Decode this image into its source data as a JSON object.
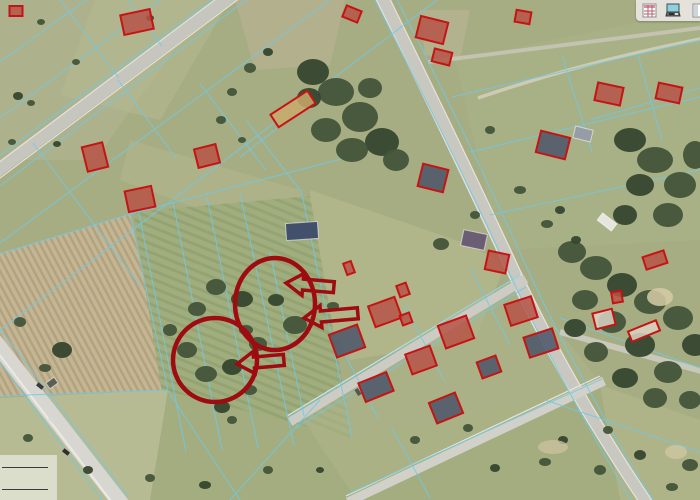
{
  "toolbar": {
    "icons": [
      {
        "name": "attribute-table-icon"
      },
      {
        "name": "print-preview-icon"
      },
      {
        "name": "side-panel-icon"
      }
    ]
  },
  "scalebar": {
    "bars": [
      {
        "width": 46
      },
      {
        "width": 46
      }
    ]
  },
  "map": {
    "colors": {
      "field": "#a7ad83",
      "parcel_line": "#6fc9e6",
      "building_outline": "#c51414",
      "annotation": "#9e0b10",
      "roofs": {
        "red": "#b65348",
        "dark": "#4b5569",
        "light": "#dad3c5",
        "tan": "#c9a96a"
      }
    },
    "buildings": [
      [
        16,
        11,
        13,
        10,
        0,
        "red"
      ],
      [
        137,
        22,
        30,
        20,
        -12,
        "red"
      ],
      [
        352,
        14,
        16,
        12,
        22,
        "red"
      ],
      [
        95,
        157,
        21,
        25,
        -14,
        "red"
      ],
      [
        207,
        156,
        22,
        19,
        -14,
        "red"
      ],
      [
        140,
        199,
        27,
        21,
        -12,
        "red"
      ],
      [
        293,
        109,
        44,
        15,
        -33,
        "tan"
      ],
      [
        432,
        30,
        28,
        22,
        14,
        "red"
      ],
      [
        442,
        57,
        18,
        13,
        14,
        "red"
      ],
      [
        523,
        17,
        15,
        12,
        10,
        "red"
      ],
      [
        609,
        94,
        26,
        18,
        12,
        "red"
      ],
      [
        669,
        93,
        24,
        16,
        12,
        "red"
      ],
      [
        553,
        145,
        30,
        22,
        14,
        "dark"
      ],
      [
        433,
        178,
        26,
        23,
        14,
        "dark"
      ],
      [
        497,
        262,
        21,
        19,
        12,
        "red"
      ],
      [
        521,
        311,
        28,
        22,
        -18,
        "red"
      ],
      [
        541,
        343,
        30,
        21,
        -18,
        "dark"
      ],
      [
        655,
        260,
        22,
        13,
        -18,
        "red"
      ],
      [
        617,
        297,
        10,
        11,
        -10,
        "red"
      ],
      [
        644,
        331,
        30,
        11,
        -22,
        "light"
      ],
      [
        604,
        319,
        20,
        16,
        -14,
        "light"
      ],
      [
        385,
        312,
        28,
        22,
        -20,
        "red"
      ],
      [
        347,
        341,
        30,
        24,
        -20,
        "dark"
      ],
      [
        456,
        332,
        30,
        24,
        -20,
        "red"
      ],
      [
        421,
        360,
        26,
        21,
        -20,
        "red"
      ],
      [
        376,
        387,
        30,
        20,
        -22,
        "dark"
      ],
      [
        489,
        367,
        20,
        17,
        -20,
        "dark"
      ],
      [
        446,
        408,
        28,
        22,
        -22,
        "dark"
      ],
      [
        403,
        290,
        10,
        12,
        -20,
        "red"
      ],
      [
        349,
        268,
        8,
        12,
        -20,
        "red"
      ],
      [
        406,
        319,
        10,
        10,
        -20,
        "red"
      ]
    ],
    "other_buildings": [
      [
        302,
        231,
        32,
        17,
        -4,
        "#43506b"
      ],
      [
        474,
        240,
        24,
        16,
        12,
        "#6b5e74"
      ],
      [
        583,
        134,
        18,
        12,
        14,
        "#979da6"
      ],
      [
        607,
        222,
        18,
        9,
        38,
        "#e6e6df"
      ],
      [
        52,
        383,
        10,
        7,
        -36,
        "#5a5f52"
      ]
    ],
    "annotations": {
      "circles": [
        {
          "cx": 275,
          "cy": 304,
          "rx": 40,
          "ry": 46
        },
        {
          "cx": 215,
          "cy": 360,
          "rx": 42,
          "ry": 42
        }
      ],
      "arrows": [
        {
          "x": 286,
          "y": 283,
          "len": 48,
          "rot": 5
        },
        {
          "x": 304,
          "y": 318,
          "len": 54,
          "rot": -5
        },
        {
          "x": 237,
          "y": 364,
          "len": 47,
          "rot": -5
        }
      ]
    }
  }
}
